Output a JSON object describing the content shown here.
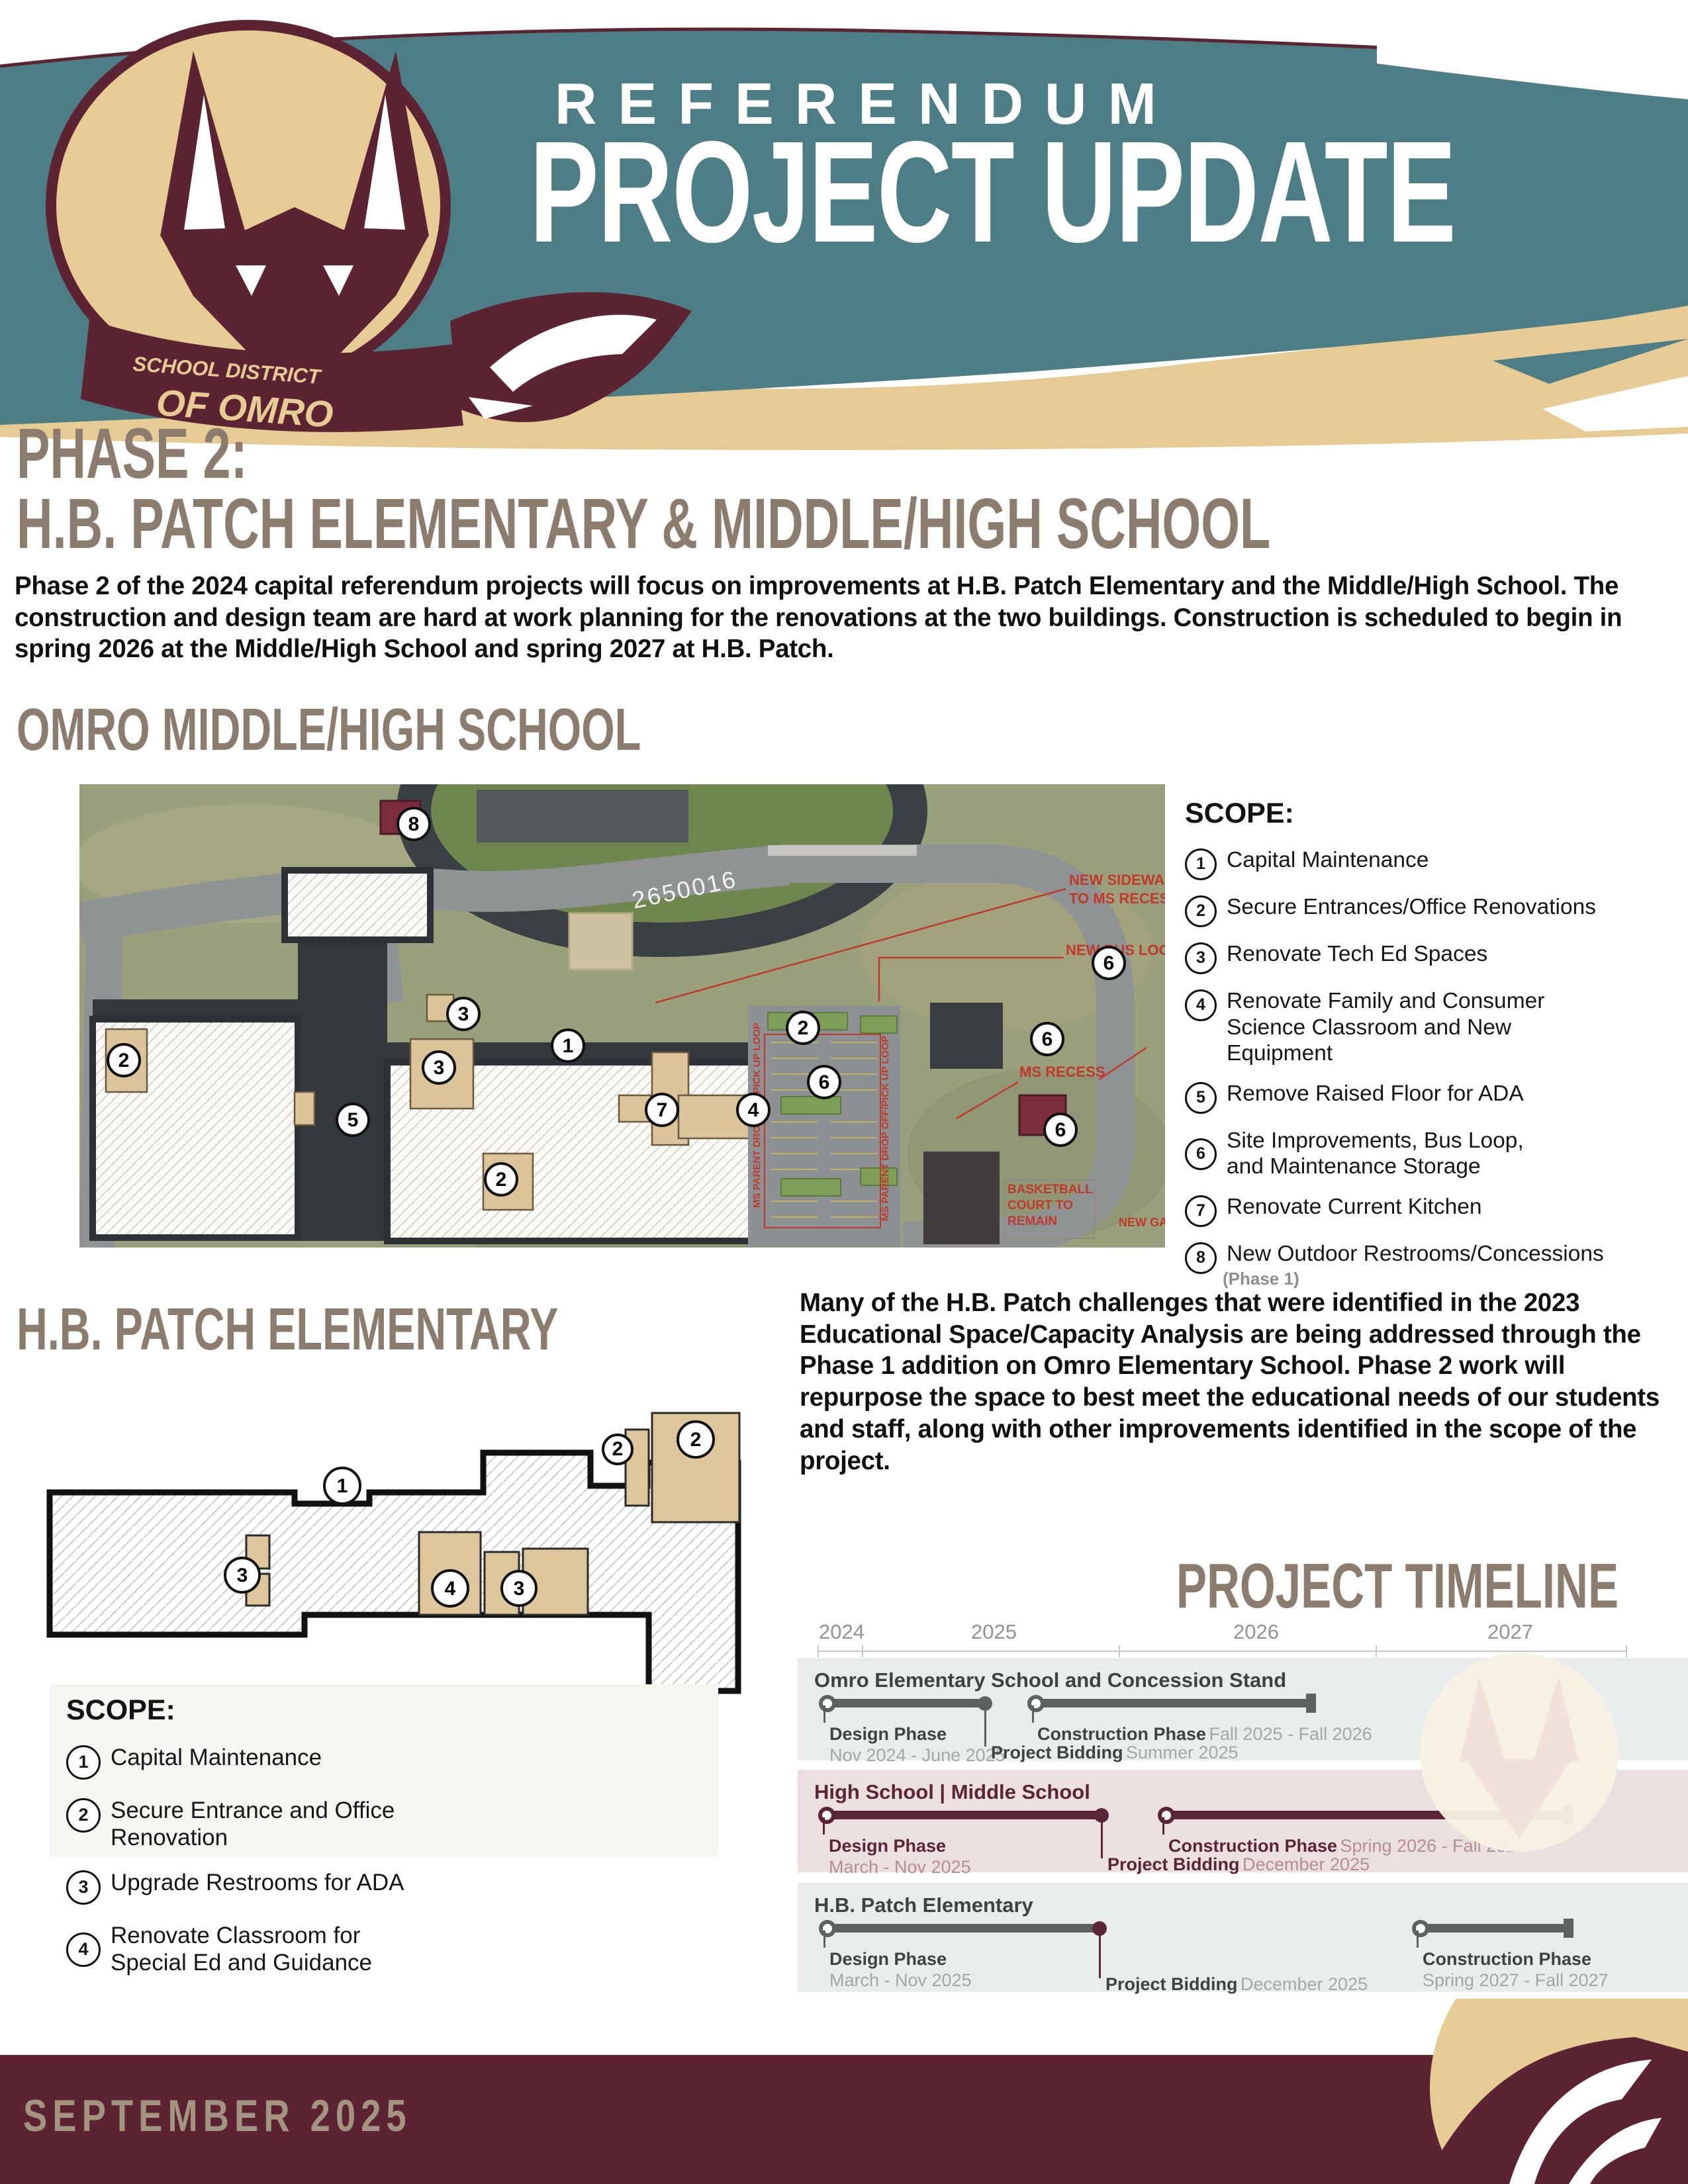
{
  "header": {
    "kicker": "REFERENDUM",
    "title": "PROJECT UPDATE",
    "logo_line1": "SCHOOL DISTRICT",
    "logo_line2": "OF OMRO",
    "colors": {
      "teal": "#4d7e86",
      "tan": "#e7cb94",
      "maroon": "#5c2433"
    }
  },
  "intro": {
    "heading1": "PHASE 2:",
    "heading2": "H.B. PATCH ELEMENTARY & MIDDLE/HIGH SCHOOL",
    "body": "Phase 2 of the 2024 capital referendum projects will focus on improvements at H.B. Patch Elementary and the Middle/High School. The construction and design team are hard at work planning for the renovations at the two buildings. Construction is scheduled to begin in spring 2026 at the Middle/High School and spring 2027 at H.B. Patch."
  },
  "middle_high": {
    "heading": "OMRO MIDDLE/HIGH SCHOOL",
    "scope_title": "SCOPE:",
    "scope": [
      {
        "num": "1",
        "text": "Capital Maintenance"
      },
      {
        "num": "2",
        "text": "Secure Entrances/Office Renovations"
      },
      {
        "num": "3",
        "text": "Renovate Tech Ed Spaces"
      },
      {
        "num": "4",
        "text": "Renovate Family and Consumer Science Classroom and New Equipment"
      },
      {
        "num": "5",
        "text": "Remove Raised Floor for ADA"
      },
      {
        "num": "6",
        "text": "Site Improvements, Bus Loop, and Maintenance Storage"
      },
      {
        "num": "7",
        "text": "Renovate Current Kitchen"
      },
      {
        "num": "8",
        "text": "New Outdoor Restrooms/Concessions",
        "note": "(Phase 1)"
      }
    ],
    "map": {
      "markers": [
        "8",
        "2",
        "3",
        "3",
        "1",
        "5",
        "2",
        "7",
        "4",
        "2",
        "6",
        "6",
        "6",
        "6"
      ],
      "annotations": {
        "sidewalk1": "NEW SIDEWALK",
        "sidewalk2": "TO MS RECESS",
        "bus_loop": "NEW BUS LOOP",
        "ms_recess": "MS RECESS",
        "bb1": "BASKETBALL",
        "bb2": "COURT TO",
        "bb3": "REMAIN",
        "new_gate": "NEW GATE",
        "drop_loop": "MS PARENT DROP OFF/PICK UP LOOP",
        "photo_id": "2650016"
      }
    }
  },
  "hb_patch": {
    "heading": "H.B. PATCH ELEMENTARY",
    "scope_title": "SCOPE:",
    "scope": [
      {
        "num": "1",
        "text": "Capital Maintenance"
      },
      {
        "num": "2",
        "text": "Secure Entrance and Office Renovation"
      },
      {
        "num": "3",
        "text": "Upgrade Restrooms for ADA"
      },
      {
        "num": "4",
        "text": "Renovate Classroom for Special Ed and Guidance"
      }
    ],
    "plan_markers": [
      "1",
      "2",
      "2",
      "3",
      "4",
      "3"
    ]
  },
  "challenges": "Many of the H.B. Patch challenges that were identified in the 2023 Educational Space/Capacity Analysis are being addressed through the Phase 1 addition on Omro Elementary School. Phase 2 work will repurpose the space to best meet the educational needs of our students and staff, along with other improvements identified in the scope of the project.",
  "timeline": {
    "heading": "PROJECT TIMELINE",
    "years": [
      "2024",
      "2025",
      "2026",
      "2027"
    ],
    "rows": [
      {
        "title": "Omro Elementary School and Concession Stand",
        "design_label": "Design Phase",
        "design_dates": "Nov 2024 - June 2025",
        "bidding_label": "Project Bidding",
        "bidding_dates": "Summer 2025",
        "construction_label": "Construction Phase",
        "construction_dates": "Fall 2025 - Fall 2026"
      },
      {
        "title": "High School | Middle School",
        "design_label": "Design Phase",
        "design_dates": "March - Nov 2025",
        "bidding_label": "Project Bidding",
        "bidding_dates": "December 2025",
        "construction_label": "Construction Phase",
        "construction_dates": "Spring 2026 - Fall 2027"
      },
      {
        "title": "H.B. Patch Elementary",
        "design_label": "Design Phase",
        "design_dates": "March - Nov 2025",
        "bidding_label": "Project Bidding",
        "bidding_dates": "December 2025",
        "construction_label": "Construction Phase",
        "construction_dates": "Spring 2027 - Fall 2027"
      }
    ]
  },
  "footer": {
    "date": "SEPTEMBER 2025"
  }
}
